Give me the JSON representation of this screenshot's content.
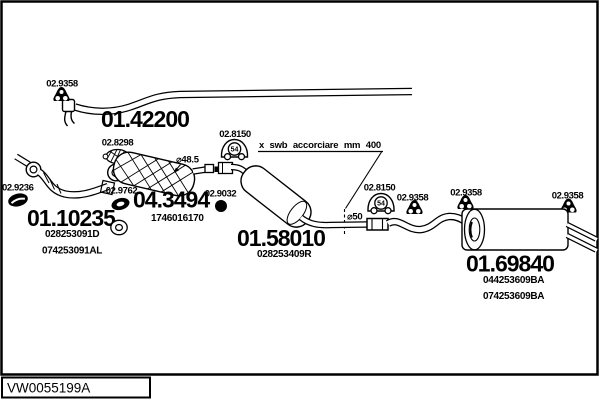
{
  "page": {
    "background": "#ffffff",
    "ink": "#000000",
    "code_plate": "VW0055199A"
  },
  "note": {
    "shorten": "x swb accorciare mm 400",
    "diameter_cat_pipe": "⌀48.5",
    "diameter_mid_pipe": "⌀50"
  },
  "parts": {
    "front_pipe": {
      "code": "01.42200"
    },
    "down_pipe": {
      "code": "01.10235",
      "oem1": "028253091D",
      "oem2": "074253091AL"
    },
    "catalyst": {
      "code": "04.3494",
      "oem1": "1746016170"
    },
    "mid_muffler": {
      "code": "01.58010",
      "oem1": "028253409R"
    },
    "rear_muffler": {
      "code": "01.69840",
      "oem1": "044253609BA",
      "oem2": "074253609BA"
    }
  },
  "mountings": {
    "hangers": [
      "02.9358",
      "02.9358",
      "02.9358",
      "02.9358"
    ],
    "mounts54": [
      "02.8150",
      "02.8150"
    ],
    "mount54_number": "54",
    "clamp": "02.8298",
    "flange_gasket": "02.9236",
    "ring_gasket": "02.9762",
    "nut": "02.9032"
  }
}
